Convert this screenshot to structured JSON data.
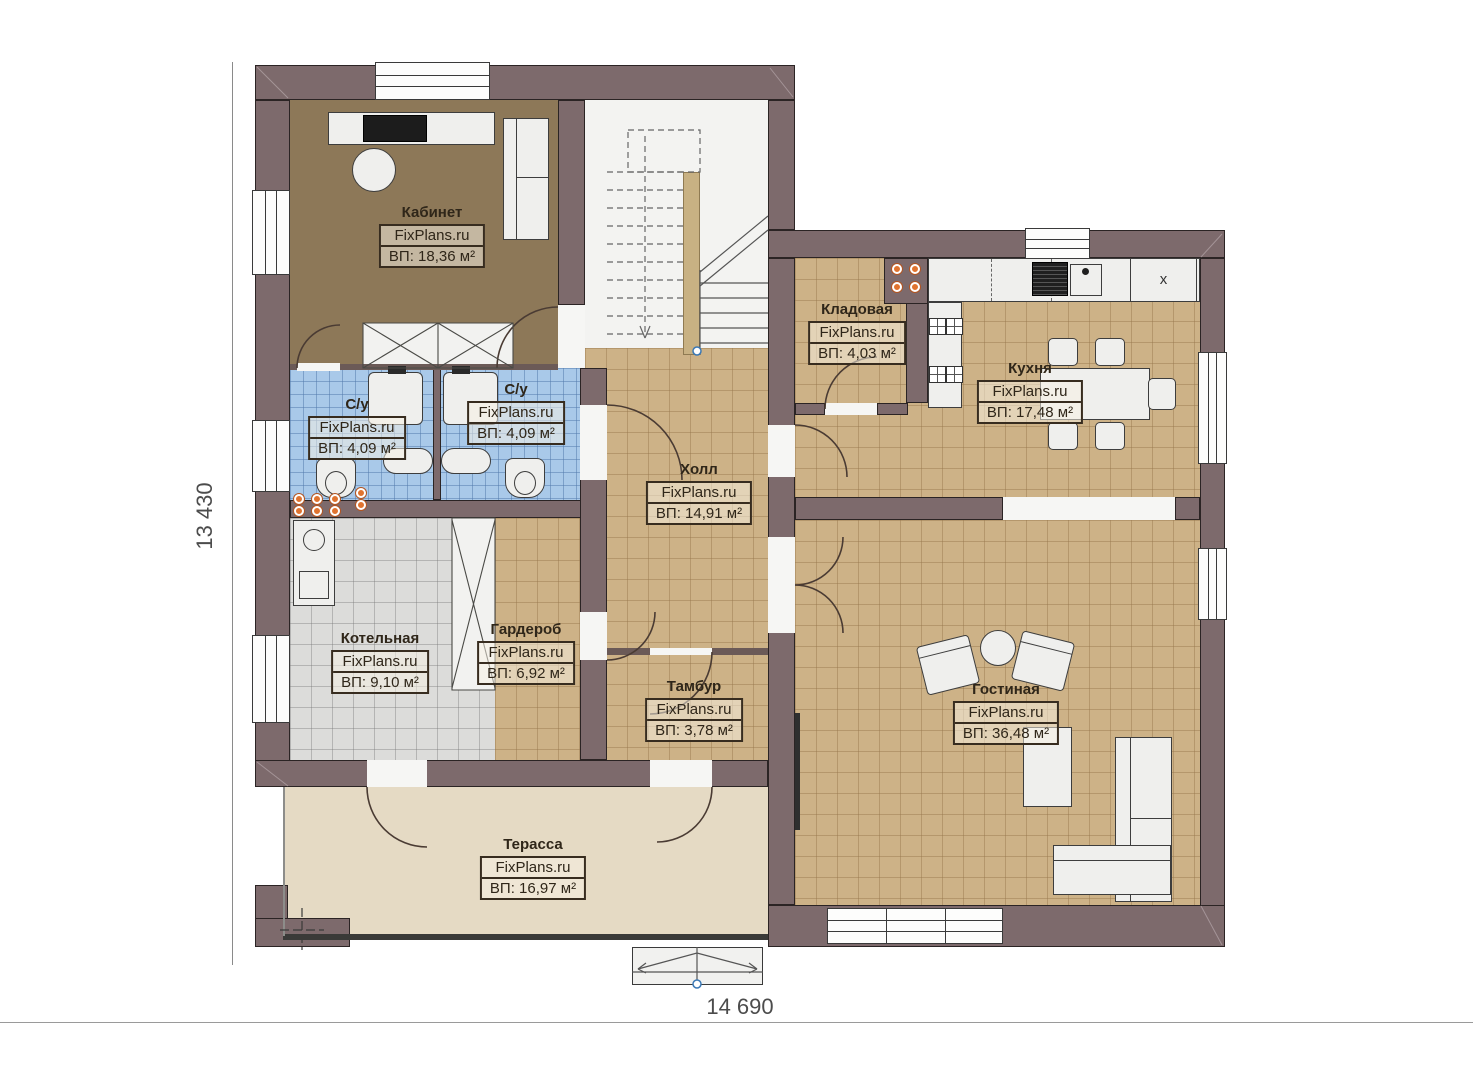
{
  "brand": "FixPlans.ru",
  "dimensions": {
    "bottom": "14 690",
    "left": "13 430"
  },
  "rooms": {
    "office": {
      "name": "Кабинет",
      "area": "ВП: 18,36 м²"
    },
    "wc1": {
      "name": "С/у",
      "area": "ВП: 4,09 м²"
    },
    "wc2": {
      "name": "С/у",
      "area": "ВП: 4,09 м²"
    },
    "storage": {
      "name": "Кладовая",
      "area": "ВП: 4,03 м²"
    },
    "kitchen": {
      "name": "Кухня",
      "area": "ВП: 17,48 м²"
    },
    "hall": {
      "name": "Холл",
      "area": "ВП: 14,91 м²"
    },
    "boiler": {
      "name": "Котельная",
      "area": "ВП: 9,10 м²"
    },
    "wardrobe": {
      "name": "Гардероб",
      "area": "ВП: 6,92 м²"
    },
    "vestibule": {
      "name": "Тамбур",
      "area": "ВП: 3,78 м²"
    },
    "living": {
      "name": "Гостиная",
      "area": "ВП: 36,48 м²"
    },
    "terrace": {
      "name": "Терасса",
      "area": "ВП: 16,97 м²"
    }
  },
  "symbols": {
    "fridge": "x"
  },
  "colors": {
    "wall": "#7d6a6c",
    "floor_tan": "#cdb287",
    "floor_blue": "#a9c9e9",
    "floor_gray": "#dcdcda",
    "floor_office": "#8d7858",
    "floor_terrace": "#e5dac4",
    "accent_orange": "#e0732f"
  }
}
